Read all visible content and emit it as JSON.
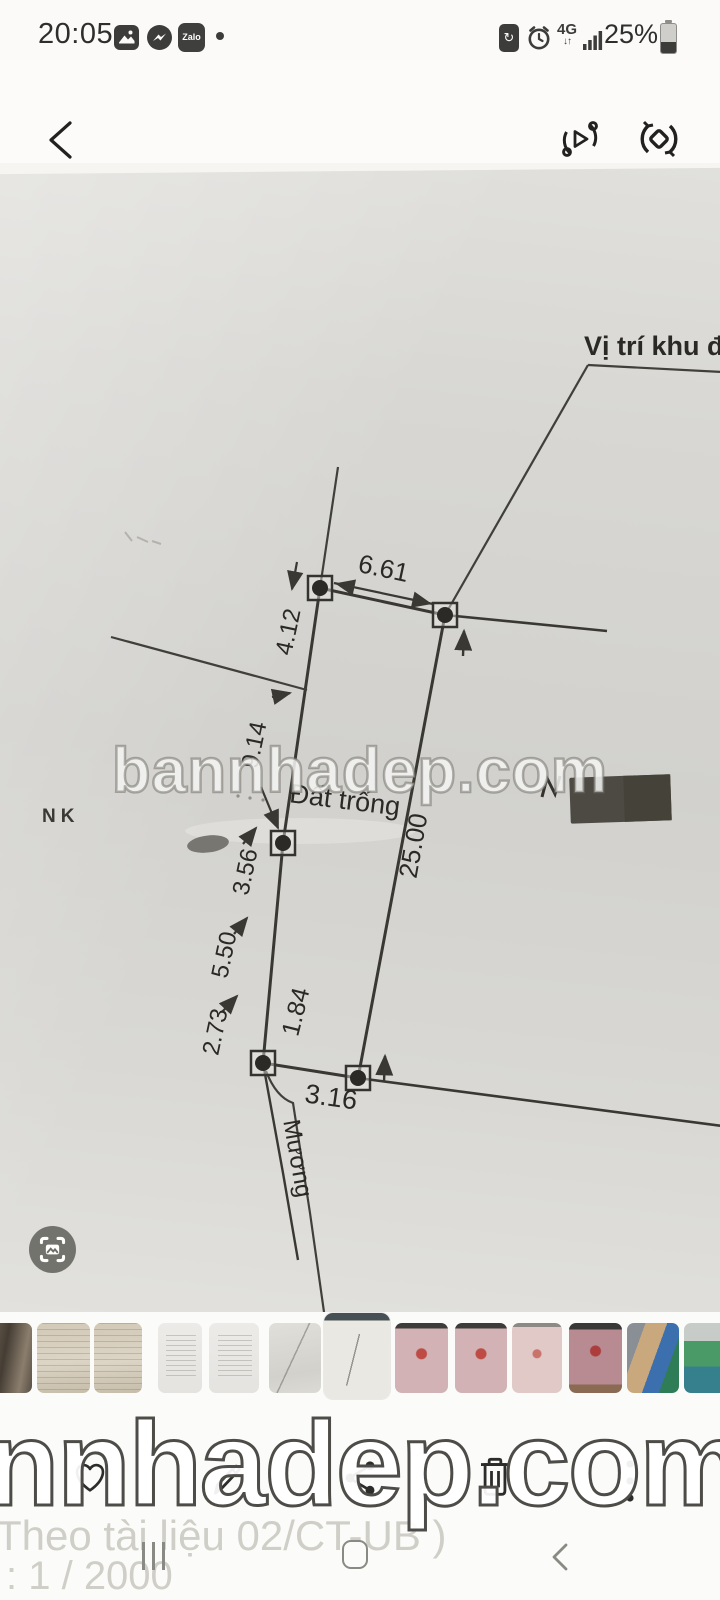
{
  "status_bar": {
    "time": "20:05",
    "zalo_label": "Zalo",
    "network_label": "4G",
    "battery_percent": "25%"
  },
  "diagram": {
    "location_label": "Vị trí khu đất",
    "plot_label": "Đất trống",
    "channel_label": "Mương",
    "margin_note": "NK",
    "dim_top": "6.61",
    "dim_right": "25.00",
    "dim_bottom": "3.16",
    "dim_inner": "1.84",
    "left_dims": [
      "4.12",
      "9.14",
      "3.56",
      "5.50",
      "2.73"
    ],
    "watermark": "bannhadep.com"
  },
  "thumbnails": {
    "items": [
      {
        "kind": "room-photo"
      },
      {
        "kind": "document-beige"
      },
      {
        "kind": "document-beige"
      },
      {
        "kind": "document-typed"
      },
      {
        "kind": "document-typed"
      },
      {
        "kind": "sketch-page"
      },
      {
        "kind": "current-diagram",
        "selected": true
      },
      {
        "kind": "certificate-pink"
      },
      {
        "kind": "certificate-pink"
      },
      {
        "kind": "certificate-pink-light"
      },
      {
        "kind": "certificate-red"
      },
      {
        "kind": "people-photo"
      },
      {
        "kind": "sports-court"
      }
    ]
  },
  "footer": {
    "watermark": "nnhadep.com",
    "faint_note_line1": "Theo tài liệu 02/CT-UB )",
    "faint_note_line2": ":  1 / 2000"
  }
}
